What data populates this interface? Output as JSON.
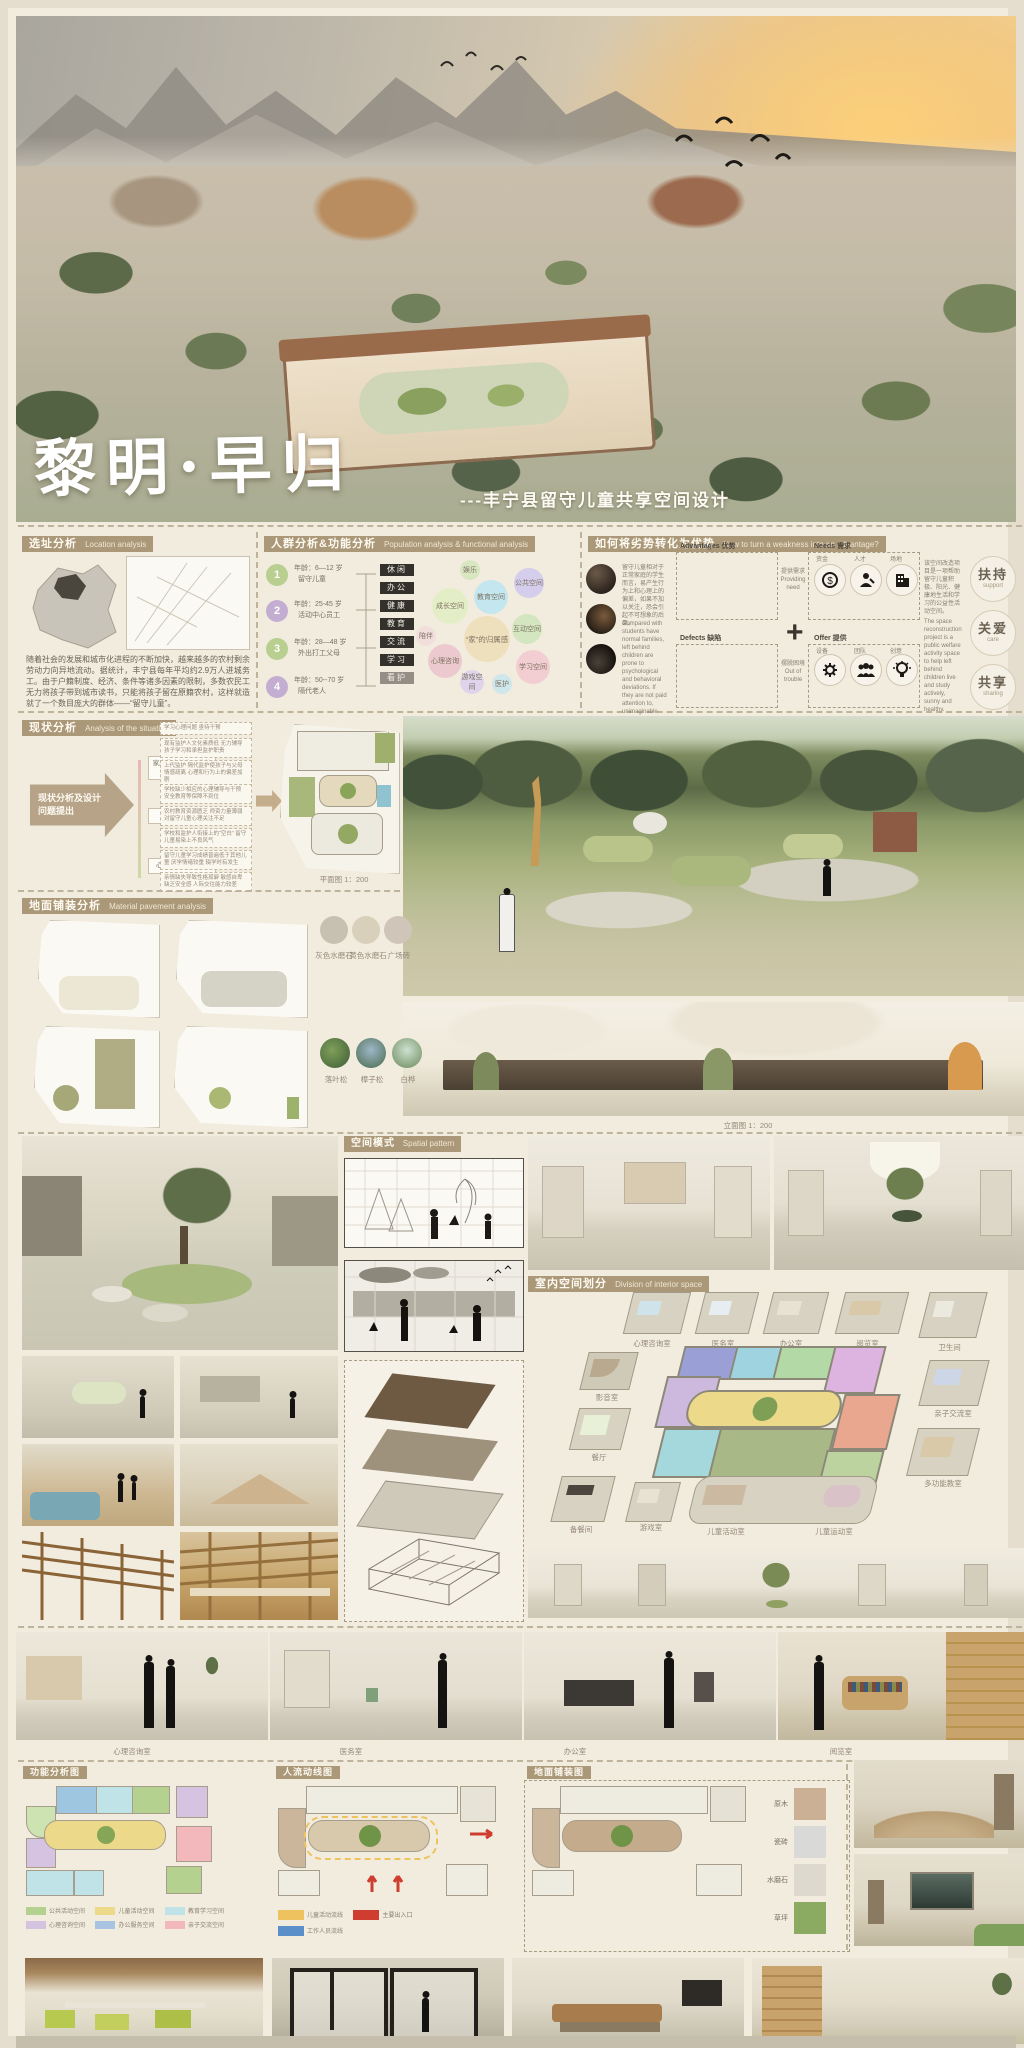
{
  "poster": {
    "title": "黎明·早归",
    "subtitle": "---丰宁县留守儿童共享空间设计"
  },
  "location": {
    "title_zh": "选址分析",
    "title_en": "Location analysis",
    "paragraph": "随着社会的发展和城市化进程的不断加快，越来越多的农村剩余劳动力向异地流动。据统计，丰宁县每年平均约2.9万人进城务工。由于户籍制度、经济、条件等诸多因素的限制，多数农民工无力将孩子带到城市读书，只能将孩子留在原籍农村，这样就造就了一个数目庞大的群体——“留守儿童”。"
  },
  "population": {
    "title_zh": "人群分析&功能分析",
    "title_en": "Population analysis & functional analysis",
    "groups": [
      {
        "num": "1",
        "age": "年龄：6—12 岁",
        "role": "留守儿童"
      },
      {
        "num": "2",
        "age": "年龄：25-45 岁",
        "role": "活动中心员工"
      },
      {
        "num": "3",
        "age": "年龄：28—48 岁",
        "role": "外出打工父母"
      },
      {
        "num": "4",
        "age": "年龄：50--70 岁",
        "role": "隔代老人"
      }
    ],
    "tags": [
      "休闲",
      "办公",
      "健康",
      "教育",
      "交流",
      "学习",
      "看护"
    ],
    "bubbles": [
      "娱乐",
      "成长空间",
      "教育空间",
      "公共空间",
      "陪伴",
      "心理咨询",
      "“家”的归属感",
      "互动空间",
      "学习空间",
      "游戏空间",
      "医护"
    ]
  },
  "advantage": {
    "title_zh": "如何将劣势转化为优势",
    "title_en": "How to turn a weakness into an advantage?",
    "left_zh": "留守儿童相对于正常家庭的学生而言，易产生行为上和心理上的偏差，如果不加以关注，恐会引起不可想象的后果。",
    "left_en": "Compared with students have normal families, left behind children are prone to psychological and behavioral deviations. If they are not paid attention to, unimaginable consequences may occur.",
    "adv_label": "Advantages 优势",
    "needs_label": "Needs 需求",
    "defects_label": "Defects 缺陷",
    "offer_label": "Offer 提供",
    "arrow_top_zh": "提供需求",
    "arrow_top_en": "Providing need",
    "arrow_bottom_zh": "摆脱困境",
    "arrow_bottom_en": "Out of trouble",
    "needs_items": [
      "资金",
      "人才",
      "场地"
    ],
    "offer_items": [
      "设备",
      "团队",
      "创意"
    ],
    "right_zh": "该空间改造项目是一项帮助留守儿童积极、阳光、健康地生活和学习的公益性活动空间。",
    "right_en": "The space reconstruction project is a public welfare activity space to help left behind children live and study actively, sunny and healthy.",
    "keywords": [
      {
        "zh": "扶持",
        "en": "support"
      },
      {
        "zh": "关爱",
        "en": "care"
      },
      {
        "zh": "共享",
        "en": "sharing"
      }
    ]
  },
  "situation": {
    "title_zh": "现状分析",
    "title_en": "Analysis of the situation",
    "arrow_label": "现状分析及设计问题提出",
    "categories": [
      "家庭教育缺失及监护不足",
      "学校教育不足",
      "心理健康状况堪忧"
    ],
    "issues": [
      "学习心理问题 亟待干预",
      "现有监护人文化素质低 无力辅导孩子学习和承担监护职责",
      "上代监护 隔代监护使孩子与父母情感疏离 心理和行为上的偏差加剧",
      "学校缺少相应的心理辅导与干预 安全教育等保障不到位",
      "农村教育资源匮乏 师资力量薄弱 对留守儿童心理关注不足",
      "学校和监护人衔接上的“空白” 留守儿童易染上不良风气",
      "留守儿童学习成绩普遍低于其他儿童 厌学情绪较重 辍学时有发生",
      "亲情缺失导致性格孤僻 敏感自卑 缺乏安全感 人际交往能力较差"
    ],
    "plan_caption": "平面图 1：200"
  },
  "pavement": {
    "title_zh": "地面铺装分析",
    "title_en": "Material pavement analysis",
    "materials": [
      "灰色水磨石",
      "黄色水磨石",
      "广场砖"
    ],
    "trees": [
      "落叶松",
      "樟子松",
      "白桦"
    ]
  },
  "elevation_caption": "立面图 1：200",
  "spatial": {
    "title_zh": "空间模式",
    "title_en": "Spatial pattern"
  },
  "interior": {
    "title_zh": "室内空间划分",
    "title_en": "Division of interior space",
    "rooms_top": [
      "心理咨询室",
      "医务室",
      "办公室",
      "阅览室",
      "卫生间"
    ],
    "room_av": "影音室",
    "room_dining": "餐厅",
    "room_prep": "备餐间",
    "room_play": "游戏室",
    "room_activity": "儿童活动室",
    "room_sport": "儿童运动室",
    "room_family": "亲子交流室",
    "room_multi": "多功能教室"
  },
  "panorama": {
    "labels": [
      "心理咨询室",
      "医务室",
      "办公室",
      "阅览室"
    ]
  },
  "bottom_plans": {
    "headers": [
      "功能分析图",
      "人流动线图",
      "地面铺装图"
    ],
    "function_legend": [
      {
        "label": "公共活动空间",
        "color": "#b5d18f"
      },
      {
        "label": "儿童活动空间",
        "color": "#ecd98a"
      },
      {
        "label": "教育学习空间",
        "color": "#bfe3e6"
      },
      {
        "label": "心理咨询空间",
        "color": "#d6c3e2"
      },
      {
        "label": "办公服务空间",
        "color": "#a9c4e0"
      },
      {
        "label": "亲子交流空间",
        "color": "#f3b8bc"
      }
    ],
    "circulation_legend": [
      {
        "label": "儿童活动流线",
        "color": "#eec25f"
      },
      {
        "label": "主要出入口",
        "color": "#cf3d30"
      },
      {
        "label": "工作人员流线",
        "color": "#5b8fc9"
      }
    ]
  },
  "materials_right": [
    {
      "label": "原木",
      "color": "#cbb095"
    },
    {
      "label": "瓷砖",
      "color": "#d9d9d7"
    },
    {
      "label": "水磨石",
      "color": "#ddd9cf"
    },
    {
      "label": "草坪",
      "color": "#8cab62"
    }
  ],
  "colors": {
    "accent_bar": "#ab9878",
    "poster_bg": "#f2ecdf",
    "tag_dark": "#34302c"
  }
}
